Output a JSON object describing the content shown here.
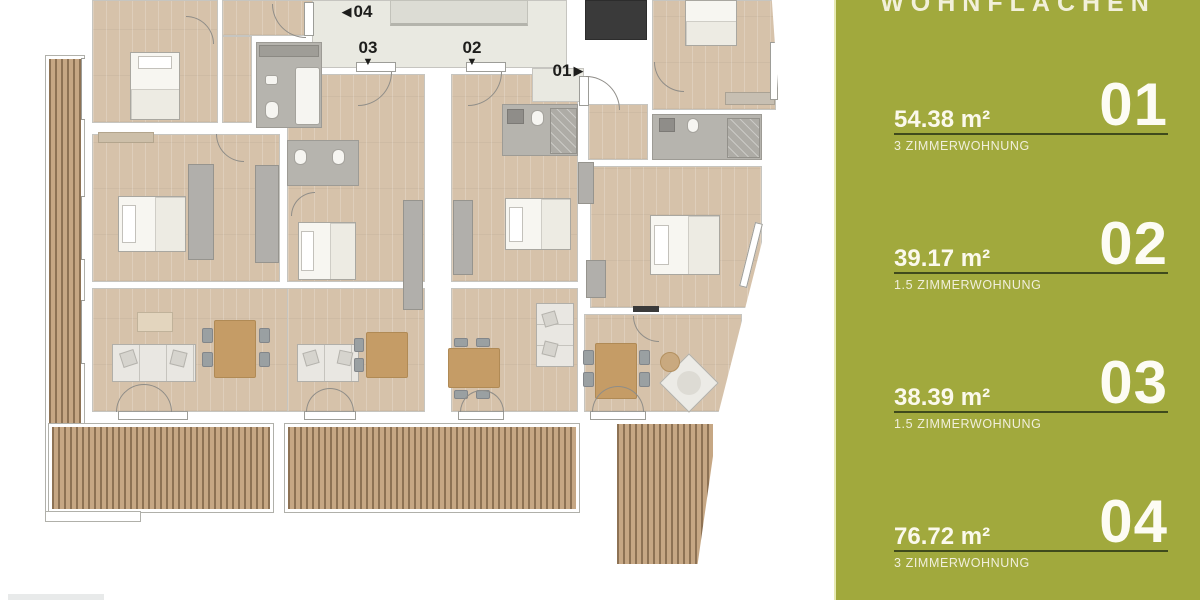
{
  "floorplan": {
    "markers": {
      "unit04": {
        "label": "04",
        "arrow": "◀"
      },
      "unit03": {
        "label": "03",
        "arrow": "▼"
      },
      "unit02": {
        "label": "02",
        "arrow": "▼"
      },
      "unit01": {
        "label": "01",
        "arrow": "▶"
      }
    },
    "colors": {
      "floor": "#d6c2aa",
      "corridor": "#e9e9e1",
      "bathroom": "#b6b4ae",
      "elevator": "#3a3a3a",
      "wood_deck": "#c6a784"
    }
  },
  "sidebar": {
    "title": "WOHNFLÄCHEN",
    "units": [
      {
        "number": "01",
        "area": "54.38 m²",
        "type": "3 ZIMMERWOHNUNG"
      },
      {
        "number": "02",
        "area": "39.17 m²",
        "type": "1.5 ZIMMERWOHNUNG"
      },
      {
        "number": "03",
        "area": "38.39 m²",
        "type": "1.5 ZIMMERWOHNUNG"
      },
      {
        "number": "04",
        "area": "76.72 m²",
        "type": "3 ZIMMERWOHNUNG"
      }
    ],
    "colors": {
      "background": "#a1a93d",
      "accent_line": "#e7eab4",
      "divider": "#3f4a1c",
      "text": "#faf8ea"
    }
  }
}
